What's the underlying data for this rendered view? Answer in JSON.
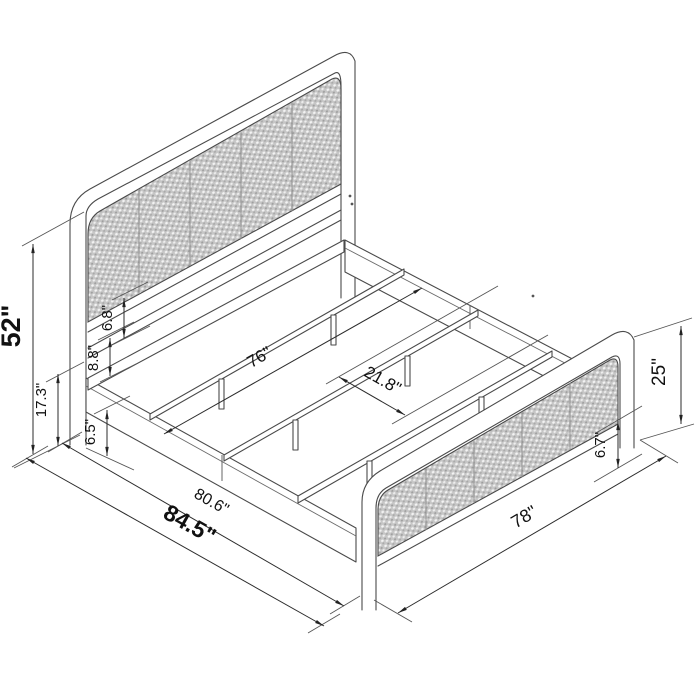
{
  "diagram": {
    "title": "bed-frame-dimension-diagram",
    "subject": "isometric metal platform bed with cane headboard and footboard panels",
    "units": "inches",
    "colors": {
      "background": "#ffffff",
      "line": "#4a4a4a",
      "dimension_line": "#2b2b2b",
      "text": "#111111",
      "cane_panel_fill": "#c6c6c6"
    },
    "dimensions": {
      "overall_height": {
        "label": "52\"",
        "meaning": "headboard overall height"
      },
      "headboard_leg_height": {
        "label": "17.3\"",
        "meaning": "floor to side rail top at headboard"
      },
      "rail_band_height": {
        "label": "6.5\"",
        "meaning": "side rail / floor clearance at headboard end"
      },
      "bar_gap": {
        "label": "8.8\"",
        "meaning": "crossbar to rail gap on headboard"
      },
      "panel_gap": {
        "label": "6.8\"",
        "meaning": "cane panel bottom to crossbar gap"
      },
      "slat_length": {
        "label": "76\"",
        "meaning": "support slat length"
      },
      "slat_spacing": {
        "label": "21.8\"",
        "meaning": "spacing between support slats"
      },
      "frame_length": {
        "label": "80.6\"",
        "meaning": "frame inner length"
      },
      "overall_length": {
        "label": "84.5\"",
        "meaning": "overall bed length"
      },
      "overall_width": {
        "label": "78\"",
        "meaning": "footboard overall width"
      },
      "footboard_height": {
        "label": "25\"",
        "meaning": "footboard overall height"
      },
      "footboard_clearance": {
        "label": "6.7\"",
        "meaning": "footboard panel to floor clearance"
      }
    }
  }
}
